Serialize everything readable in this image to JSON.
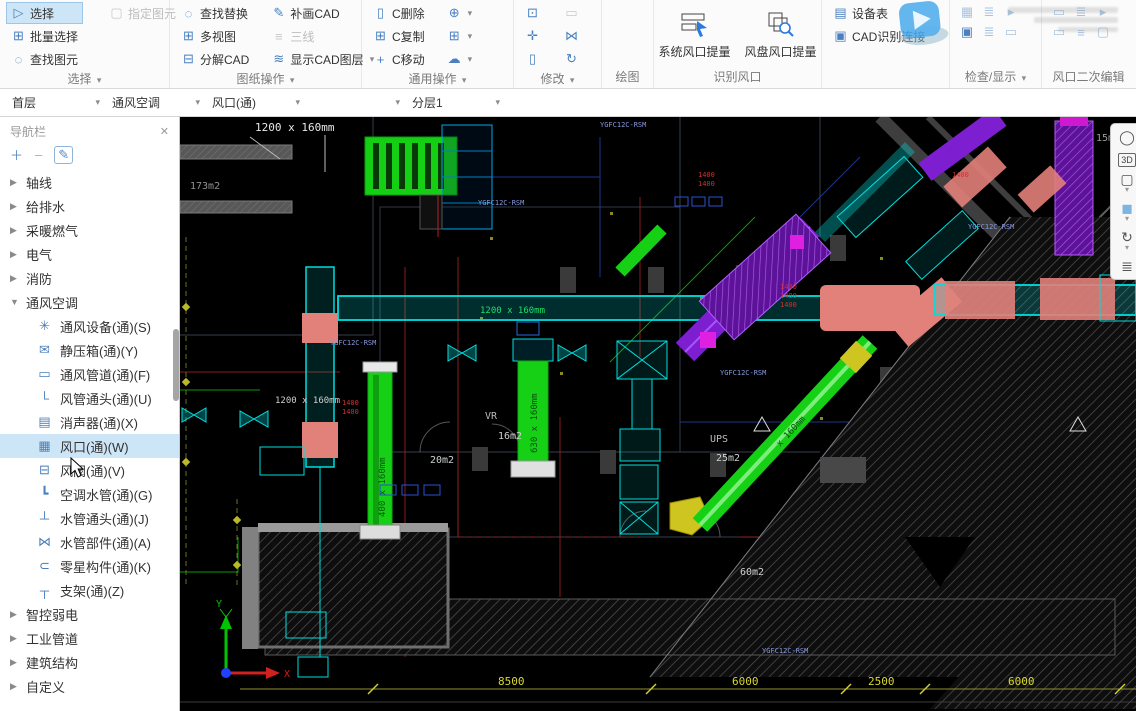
{
  "ribbon": {
    "groups": [
      {
        "label": "选择",
        "caret": "▾",
        "items": [
          {
            "label": "选择"
          },
          {
            "label": "指定图元"
          },
          {
            "label": "批量选择"
          },
          {
            "label": "查找图元"
          }
        ]
      },
      {
        "label": "图纸操作",
        "caret": "▾",
        "items": [
          {
            "label": "查找替换"
          },
          {
            "label": "多视图"
          },
          {
            "label": "分解CAD"
          },
          {
            "label": "补画CAD"
          },
          {
            "label": "三线"
          },
          {
            "label": "显示CAD图层"
          }
        ]
      },
      {
        "label": "通用操作",
        "caret": "▾",
        "items": [
          {
            "label": "C删除"
          },
          {
            "label": "C复制"
          },
          {
            "label": "C移动"
          }
        ]
      },
      {
        "label": "修改",
        "caret": "▾"
      },
      {
        "label": "绘图"
      },
      {
        "label": "识别风口",
        "items": [
          {
            "label": "系统风口提量"
          },
          {
            "label": "风盘风口提量"
          }
        ]
      },
      {
        "label": "",
        "items": [
          {
            "label": "设备表"
          },
          {
            "label": "CAD识别连接"
          }
        ]
      },
      {
        "label": "检查/显示",
        "caret": "▾"
      },
      {
        "label": "风口二次编辑"
      }
    ]
  },
  "layer_bar": {
    "items": [
      "首层",
      "通风空调",
      "风口(通)",
      "",
      "分层1"
    ]
  },
  "sidebar": {
    "title": "导航栏",
    "tree": [
      {
        "label": "轴线"
      },
      {
        "label": "给排水"
      },
      {
        "label": "采暖燃气"
      },
      {
        "label": "电气"
      },
      {
        "label": "消防"
      },
      {
        "label": "通风空调",
        "children": [
          {
            "label": "通风设备(通)(S)"
          },
          {
            "label": "静压箱(通)(Y)"
          },
          {
            "label": "通风管道(通)(F)"
          },
          {
            "label": "风管通头(通)(U)"
          },
          {
            "label": "消声器(通)(X)"
          },
          {
            "label": "风口(通)(W)"
          },
          {
            "label": "风阀(通)(V)"
          },
          {
            "label": "空调水管(通)(G)"
          },
          {
            "label": "水管通头(通)(J)"
          },
          {
            "label": "水管部件(通)(A)"
          },
          {
            "label": "零星构件(通)(K)"
          },
          {
            "label": "支架(通)(Z)"
          }
        ]
      },
      {
        "label": "智控弱电"
      },
      {
        "label": "工业管道"
      },
      {
        "label": "建筑结构"
      },
      {
        "label": "自定义"
      }
    ]
  },
  "canvas": {
    "tooltip": "1200 x 160mm",
    "dim_note": "1200 x 160mm",
    "rooms": {
      "r173": "173m2",
      "r15": "15m2",
      "vr": "VR",
      "r16": "16m2",
      "r20": "20m2",
      "ups": "UPS",
      "r25": "25m2",
      "r60": "60m2"
    },
    "duct_labels": {
      "main": "1200 x 160mm",
      "duct_a": "400 x 160mm",
      "duct_b": "630 x 160mm",
      "diag": "x 160mm"
    },
    "code": "YGFC12C-RSM",
    "red_dim": "1400",
    "dims": [
      "8500",
      "6000",
      "2500",
      "6000"
    ],
    "axis_x": "X",
    "axis_y": "Y"
  },
  "colors": {
    "accent": "#2a7ae0",
    "selected_bg": "#cde6f7",
    "duct_cyan": "#00dede",
    "duct_green": "#16d016",
    "duct_purple": "#8a2adb",
    "highlight_salmon": "#e2807a",
    "dim_yellow": "#d8d830"
  }
}
